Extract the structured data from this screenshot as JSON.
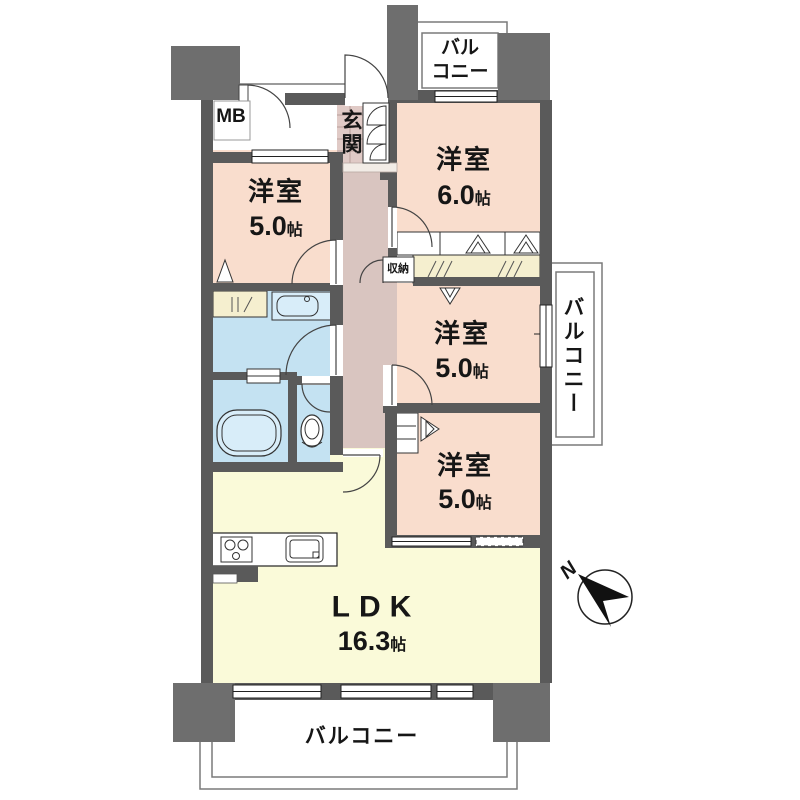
{
  "plan_title": "4LDK floor plan",
  "rooms": [
    {
      "id": "bedroom-top-left",
      "name": "洋室",
      "size_value": "5.0",
      "size_unit": "帖"
    },
    {
      "id": "bedroom-top-right",
      "name": "洋室",
      "size_value": "6.0",
      "size_unit": "帖"
    },
    {
      "id": "bedroom-mid-right",
      "name": "洋室",
      "size_value": "5.0",
      "size_unit": "帖"
    },
    {
      "id": "bedroom-bottom-right",
      "name": "洋室",
      "size_value": "5.0",
      "size_unit": "帖"
    },
    {
      "id": "ldk",
      "name": "LDK",
      "size_value": "16.3",
      "size_unit": "帖"
    }
  ],
  "labels": {
    "entrance": "玄関",
    "meter_box": "MB",
    "storage": "収納",
    "balcony_bottom": "バルコニー",
    "balcony_right": "バルコニー",
    "balcony_top_line1": "バル",
    "balcony_top_line2": "コニー",
    "compass_north": "N"
  },
  "colors": {
    "wall": "#5a5a5a",
    "corner_block": "#6e6e6e",
    "bedroom_pink": "#f9ddcd",
    "hallway_mauve": "#d9c5c0",
    "entrance_tile": "#e0cac6",
    "water_blue": "#c4e2f2",
    "fixture_blue": "#d8edf9",
    "ldk_yellow": "#fafad9",
    "closet_cream": "#f5efcf",
    "outline": "#333333"
  }
}
